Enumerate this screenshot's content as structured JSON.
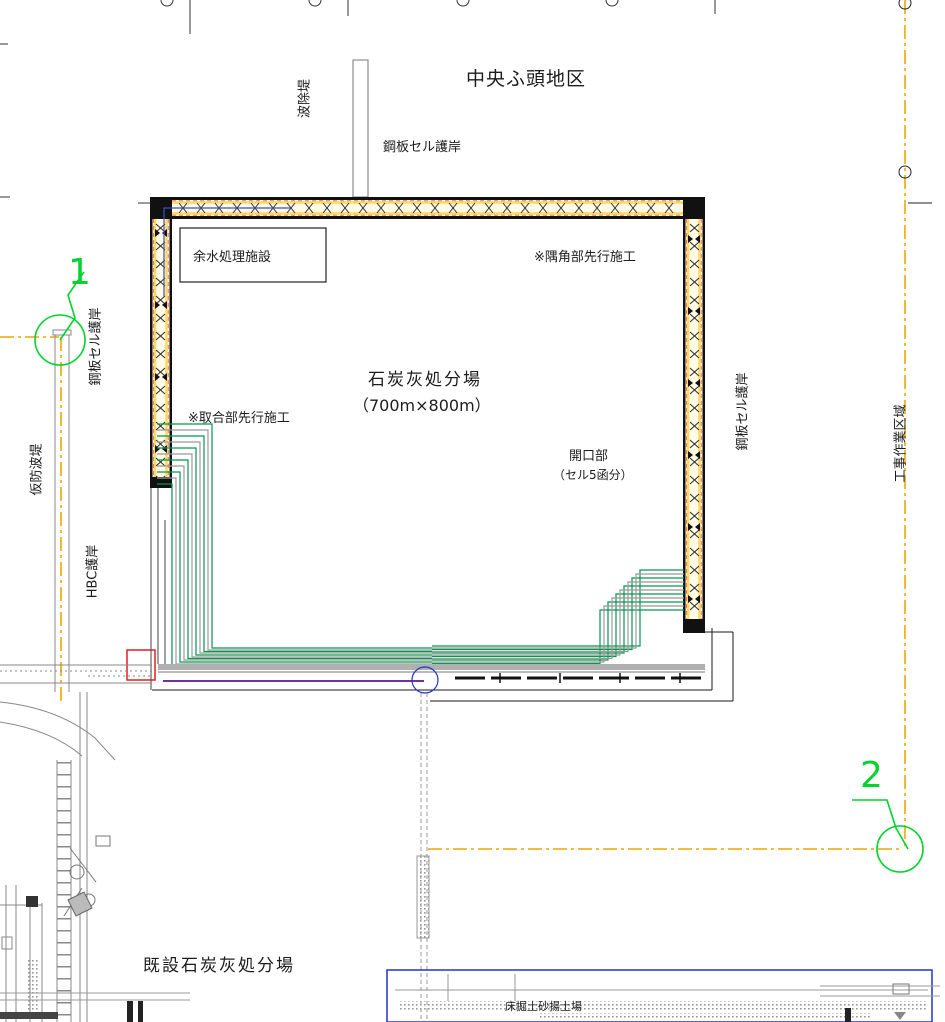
{
  "drawing": {
    "district_title": "中央ふ頭地区",
    "site_name": "石炭灰処分場",
    "site_dimensions": "（700m×800m）",
    "notes": {
      "corner_priority": "※隅角部先行施工",
      "joint_priority": "※取合部先行施工"
    },
    "facilities": {
      "surplus_water_treatment": "余水処理施設",
      "opening_line1": "開口部",
      "opening_line2": "（セル5函分）",
      "existing_site": "既設石炭灰処分場",
      "dredge_soil_yard": "床掘土砂揚土場"
    },
    "revetments": {
      "steel_cell_top": "鋼板セル護岸",
      "steel_cell_left": "鋼板セル護岸",
      "steel_cell_right": "鋼板セル護岸",
      "hbc": "HBC護岸",
      "wave_barrier": "波除堤",
      "temp_breakwater": "仮防波堤"
    },
    "work_area_boundary": "工事作業区域",
    "markers": {
      "point1": "1",
      "point2": "2"
    },
    "colors": {
      "cell_band_yellow": "#ffd95e",
      "cell_band_fill": "#fffbe8",
      "red_dash": "#ff7070",
      "green_construction_line": "#009a4e",
      "marker_green": "#00d42d",
      "survey_line_yellow": "#f3a600",
      "purple_line": "#7030a0",
      "blue_line": "#3a50c8",
      "boundary_blue": "#2233cc",
      "structure_gray": "#888888",
      "red_outline": "#e02020"
    }
  }
}
